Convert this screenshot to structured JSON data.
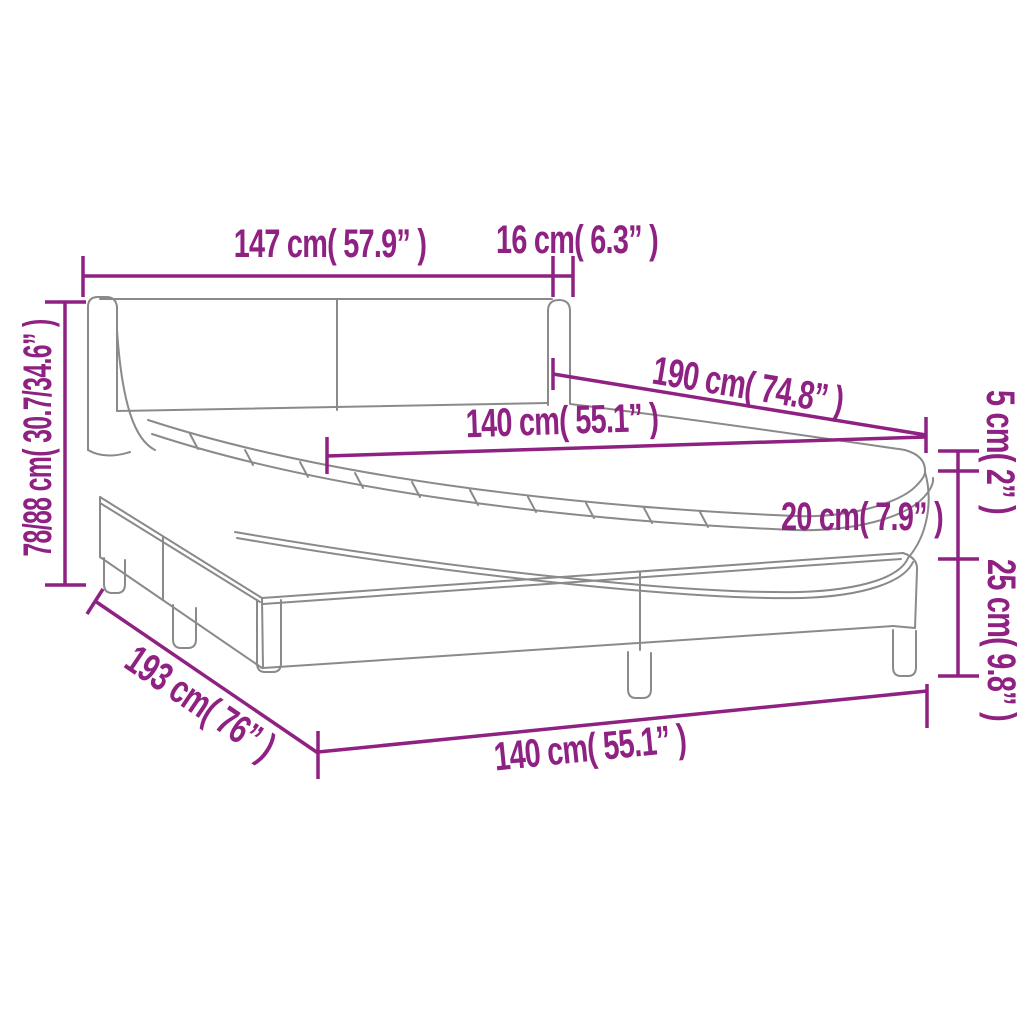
{
  "diagram": {
    "type": "product-dimension-diagram",
    "subject": "box spring bed with headboard, mattress and topper",
    "colors": {
      "accent": "#8E2181",
      "line_art": "#8A8A8A",
      "background": "#FFFFFF"
    },
    "labels": {
      "headboard_width": "147 cm( 57.9” )",
      "headboard_depth": "16 cm( 6.3” )",
      "total_height": "78/88 cm( 30.7/34.6” )",
      "bed_length": "190 cm( 74.8” )",
      "mattress_width": "140 cm( 55.1” )",
      "topper_height": "5 cm( 2” )",
      "mattress_height": "20 cm( 7.9” )",
      "base_height": "25 cm( 9.8” )",
      "base_length": "193 cm( 76” )",
      "base_width": "140 cm( 55.1” )"
    }
  }
}
